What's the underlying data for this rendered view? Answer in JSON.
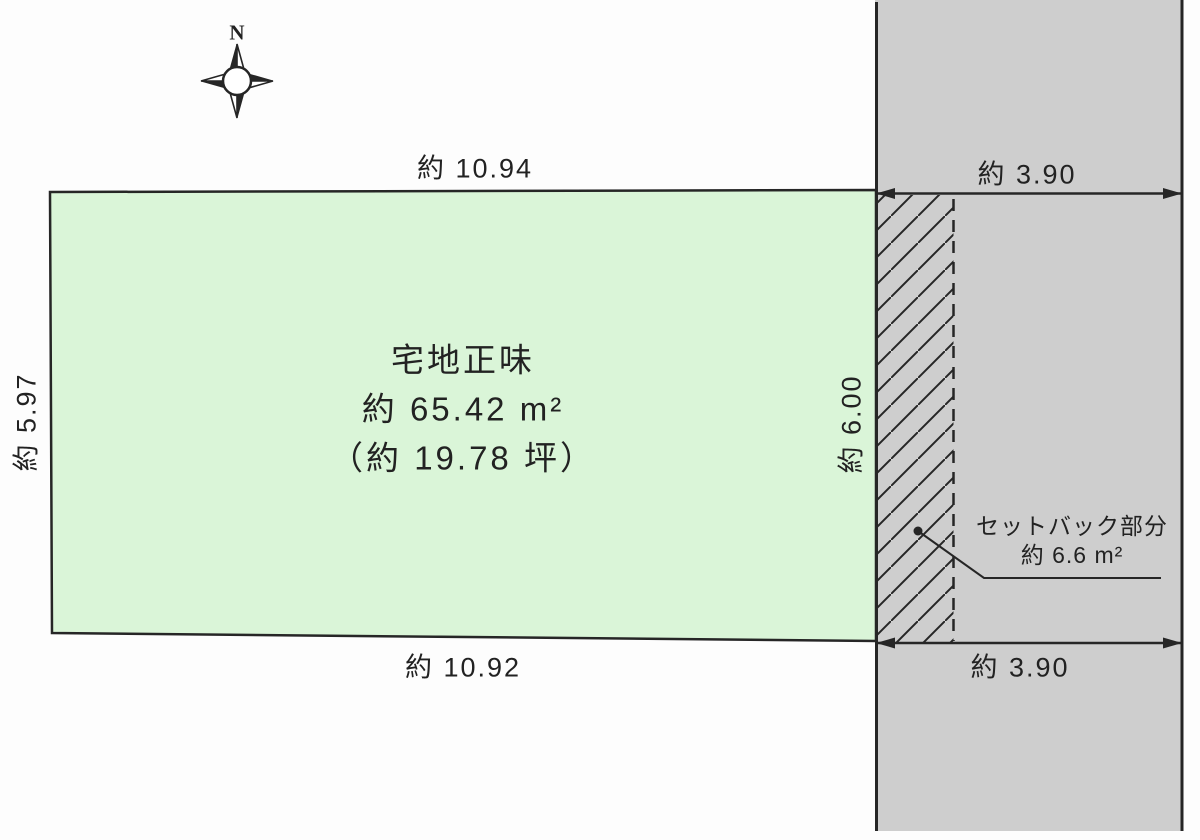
{
  "compass": {
    "label": "N"
  },
  "dimensions": {
    "top": "約 10.94",
    "bottom": "約 10.92",
    "left": "約 5.97",
    "right_inner": "約 6.00",
    "road_width_top": "約 3.90",
    "road_width_bottom": "約 3.90"
  },
  "plot_label": {
    "name": "宅地正味",
    "area_m2": "約 65.42 m²",
    "area_tsubo": "（約 19.78 坪）"
  },
  "setback_label": {
    "line1": "セットバック部分",
    "line2": "約 6.6 m²"
  },
  "colors": {
    "plot_fill": "#daf5d8",
    "road_fill": "#cecece",
    "line": "#262626",
    "text": "#222222",
    "bg": "#fdfdfd"
  }
}
